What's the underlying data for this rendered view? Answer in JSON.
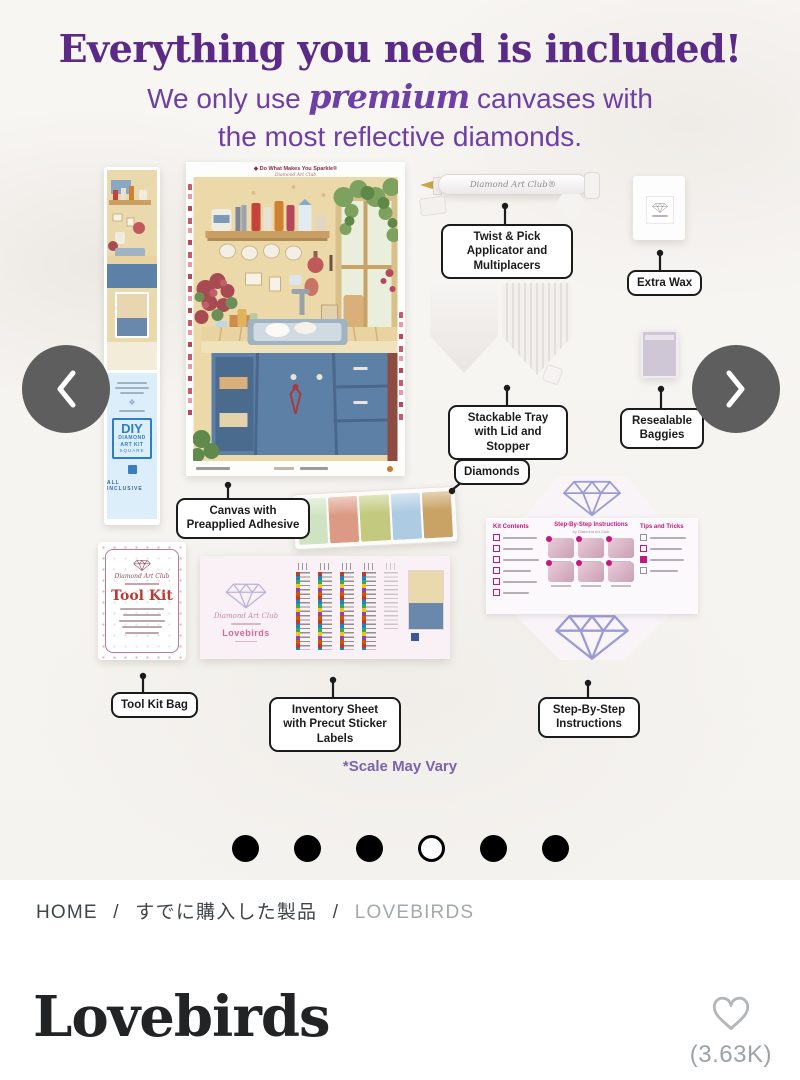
{
  "header": {
    "title": "Everything you need is included!",
    "subtitle_pre": "We only use",
    "subtitle_script": "premium",
    "subtitle_mid": "canvases with",
    "subtitle_line2": "the most reflective diamonds."
  },
  "carousel": {
    "dot_count": 6,
    "active_dot_index": 3
  },
  "kit": {
    "callouts": {
      "applicator": "Twist & Pick Applicator and Multiplacers",
      "extra_wax": "Extra Wax",
      "tray": "Stackable Tray with Lid and Stopper",
      "baggies": "Resealable Baggies",
      "diamonds": "Diamonds",
      "canvas": "Canvas with Preapplied Adhesive",
      "toolkit": "Tool Kit Bag",
      "inventory": "Inventory Sheet with Precut Sticker Labels",
      "instructions": "Step-By-Step Instructions"
    },
    "canvas": {
      "header_title": "◆ Do What Makes You Sparkle®",
      "header_brand": "Diamond Art Club"
    },
    "pen": {
      "brand": "Diamond Art Club®"
    },
    "tube": {
      "diy": "DIY",
      "line1": "DIAMOND",
      "line2": "ART KIT",
      "shape": "SQUARE",
      "inclusive": "ALL INCLUSIVE"
    },
    "toolkit": {
      "brand": "Diamond Art Club",
      "title": "Tool Kit"
    },
    "inventory": {
      "brand": "Diamond Art Club",
      "product": "Lovebirds"
    },
    "instructions": {
      "title": "Step-By-Step Instructions",
      "byline": "by Diamond Art Club",
      "left_title": "Kit Contents",
      "right_title": "Tips and Tricks"
    },
    "scale_note": "*Scale May Vary"
  },
  "breadcrumb": {
    "separator": "/",
    "items": [
      {
        "label": "HOME"
      },
      {
        "label": "すでに購入した製品"
      },
      {
        "label": "LOVEBIRDS"
      }
    ]
  },
  "product": {
    "title": "Lovebirds",
    "favorites_count": "(3.63K)"
  },
  "colors": {
    "headline_purple": "#5b2a86",
    "subtitle_purple": "#6e3fa4",
    "callout_ink": "#1b1b1b",
    "arrow_gray": "#5e5e5e",
    "magenta_accent": "#c2187e",
    "toolkit_red": "#bb3a33",
    "breadcrumb_muted": "#a3a8ad"
  }
}
